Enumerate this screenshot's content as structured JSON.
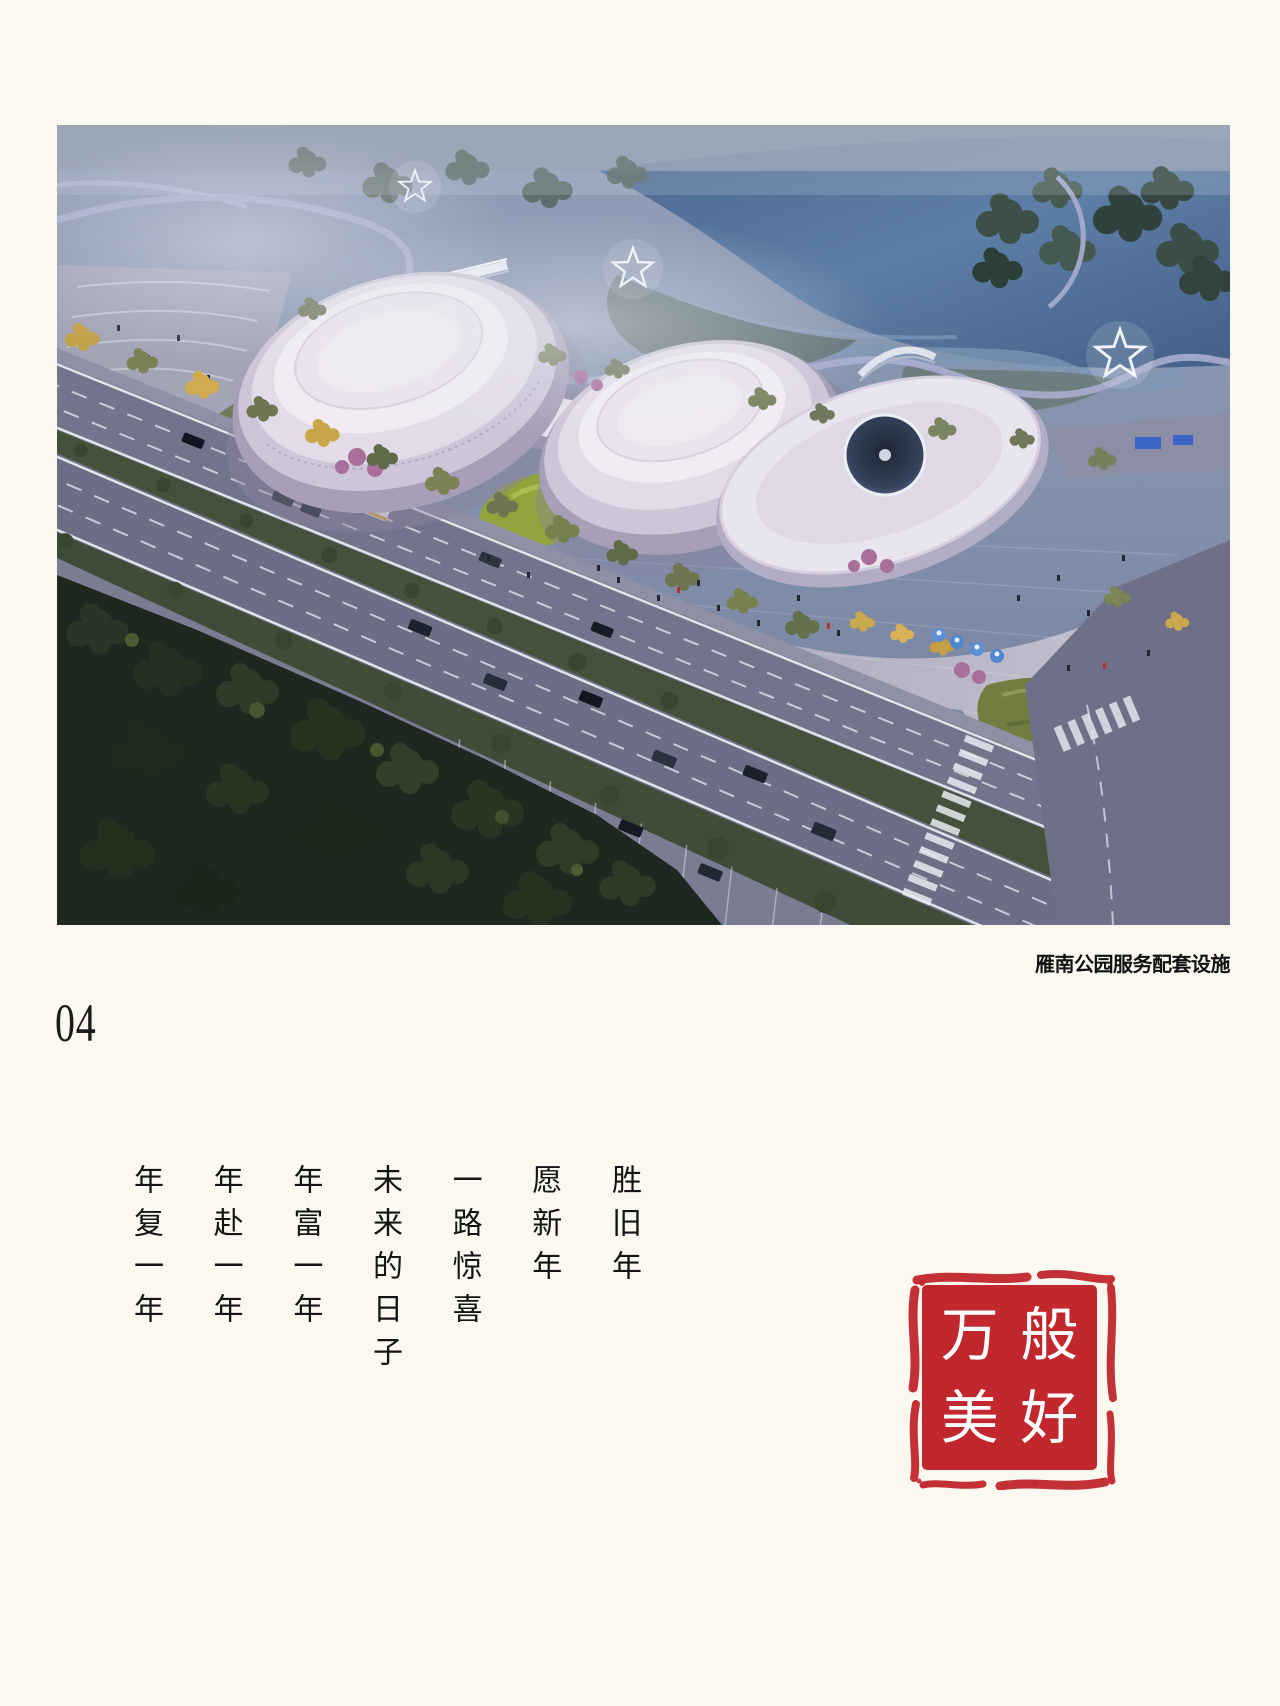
{
  "page": {
    "number": "04",
    "background_color": "#FAF8EF"
  },
  "photo": {
    "caption": "雁南公园服务配套设施"
  },
  "poem": {
    "reading_order": "right-to-left",
    "columns": [
      "胜旧年",
      "愿新年",
      "一路惊喜",
      "未来的日子",
      "年富一年",
      "年赴一年",
      "年复一年"
    ]
  },
  "seal": {
    "text": "万般美好",
    "characters": [
      "万",
      "般",
      "美",
      "好"
    ],
    "color": "#C1272D",
    "text_color": "#FFFFFF"
  },
  "colors": {
    "ink": "#161616",
    "seal_red": "#C1272D",
    "page_bg": "#FAF8EF",
    "photo_haze": "#9AA3BD",
    "photo_water": "#4A698F",
    "photo_building": "#EFEAF1",
    "photo_road": "#73748B",
    "photo_forest": "#243022",
    "photo_lawn": "#93A33E"
  }
}
